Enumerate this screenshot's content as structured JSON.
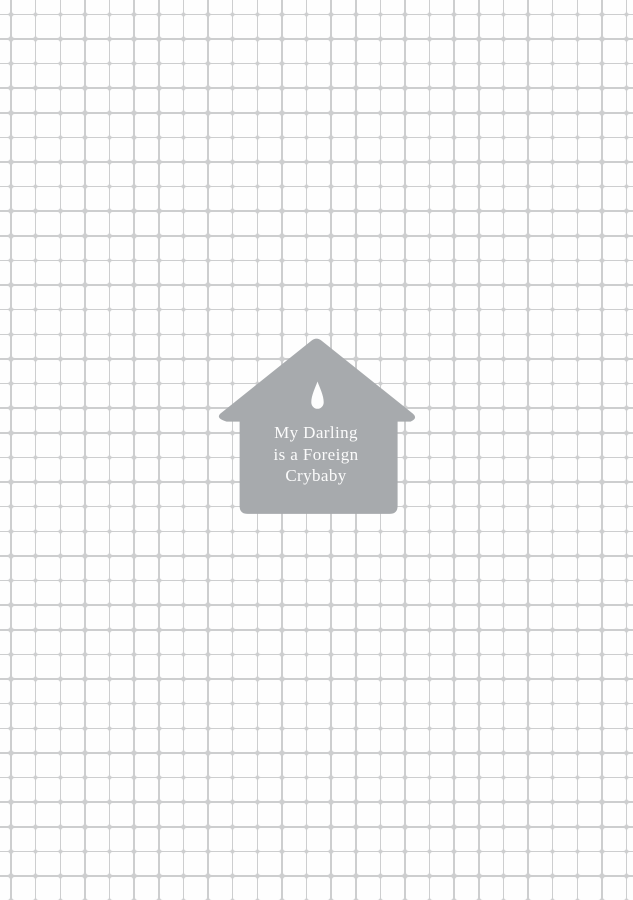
{
  "page": {
    "grid": {
      "line_color": "#cdcecf",
      "tile_color": "#fefefe",
      "spacing_px": 24.62,
      "line_width_px": 1.5
    },
    "house": {
      "color": "#a7aaad",
      "icon": "teardrop-icon",
      "icon_color": "#fdfdfd",
      "title": "My Darling is a Foreign Crybaby",
      "title_lines": [
        "My Darling",
        "is a Foreign",
        "Crybaby"
      ],
      "text_color": "#fbfbfb"
    }
  }
}
